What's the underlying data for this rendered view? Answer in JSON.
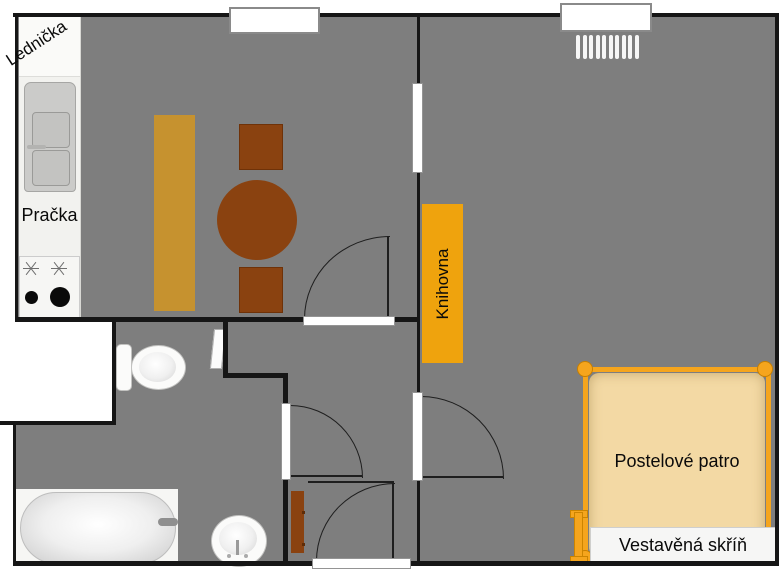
{
  "labels": {
    "fridge": "Lednička",
    "washer": "Pračka",
    "bookshelf": "Knihovna",
    "bed_loft": "Postelové patro",
    "wardrobe": "Vestavěná skříň"
  },
  "colors": {
    "floor": "#7e7e7e",
    "wall": "#161616",
    "wood": "#8a4210",
    "bench": "#c6922f",
    "amber": "#efa30d",
    "bed_frame": "#f5a51d",
    "bed_fill": "#f3d9a4"
  }
}
